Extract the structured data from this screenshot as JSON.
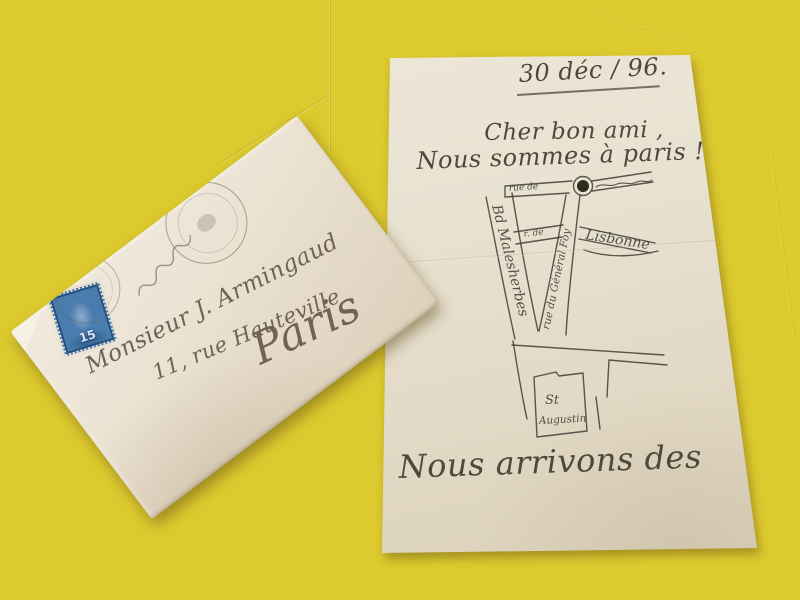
{
  "scene": {
    "background_color": "#ddca2e",
    "letter_paper_color": "#e8e2d1",
    "envelope_paper_color": "#eae1d1",
    "ink_color": "#4f483c",
    "address_ink_color": "#6e6355",
    "stamp_blue": "#4a7cae",
    "postmark_color": "#8d8577"
  },
  "letter": {
    "date_line": "30 déc / 96.",
    "salutation": "Cher bon ami ,",
    "opening_line": "Nous sommes à paris ! —",
    "closing_line": "Nous arrivons des",
    "map": {
      "street_top": "rue de",
      "street_middle": "r. de",
      "street_lisbonne": "Lisbonne",
      "street_malesherbes": "Bd Malesherbes",
      "street_general_foy": "rue du Général Foy",
      "church_line1": "St",
      "church_line2": "Augustin"
    }
  },
  "envelope": {
    "address_line1": "Monsieur J. Armingaud",
    "address_line2": "11, rue Hauteville",
    "address_line3": "Paris",
    "stamp": {
      "value": "15"
    }
  }
}
